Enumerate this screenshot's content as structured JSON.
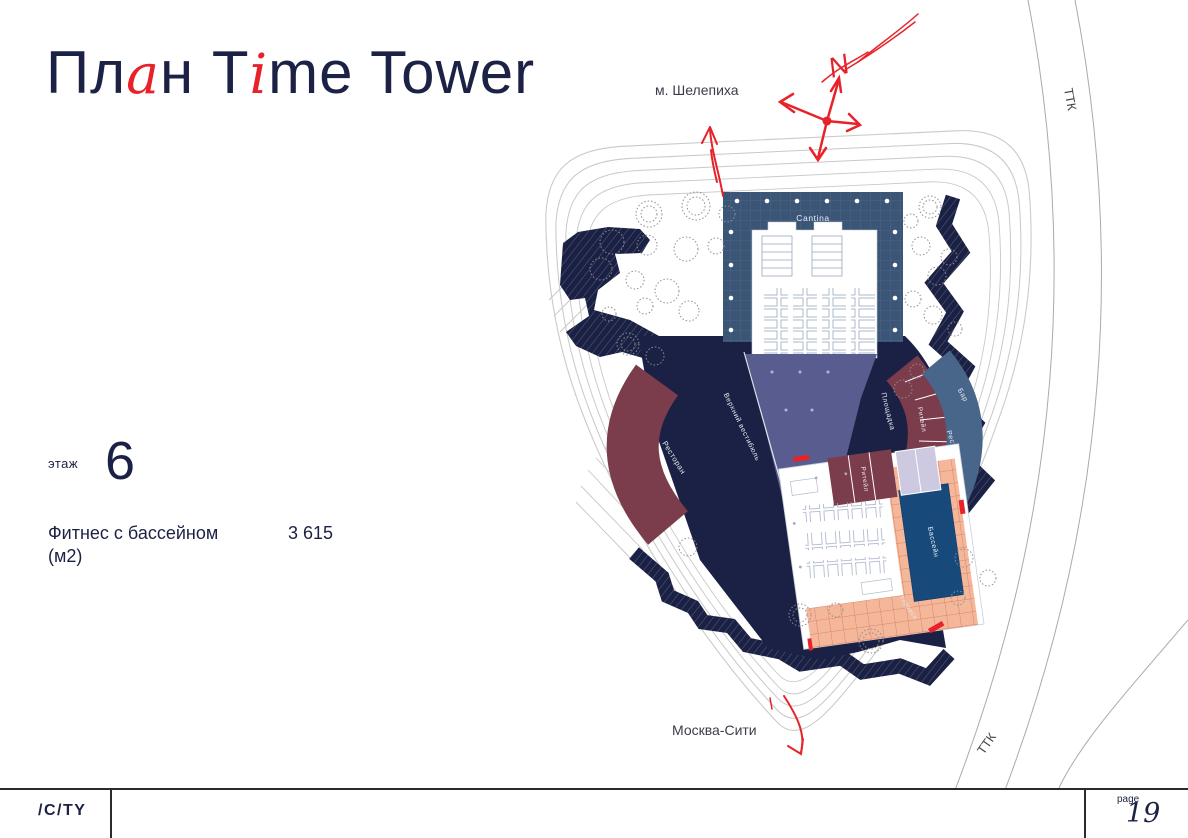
{
  "header": {
    "title_segments": [
      {
        "text": "Пл"
      },
      {
        "text": "а"
      },
      {
        "text": "н"
      },
      {
        "text": " T"
      },
      {
        "text": "i"
      },
      {
        "text": "me Tower"
      }
    ]
  },
  "info": {
    "floor_label": "этаж",
    "floor_number": "6",
    "area_label_line1": "Фитнес с бассейном",
    "area_label_line2": "(м2)",
    "area_value": "3 615"
  },
  "map": {
    "metro_label": "м. Шелепиха",
    "city_label": "Москва-Сити",
    "road_label_top": "ТТК",
    "road_label_bottom": "ТТК",
    "north_label": "N",
    "zones": {
      "cantina": "Cantina",
      "upper_lobby": "Верхний вестибюль",
      "restaurant_left": "Ресторан",
      "plaza": "Площадка",
      "retail_arc": "Ритейл",
      "bar": "Бар",
      "restaurant_right": "Ресторан",
      "retail_box": "Ритейл",
      "pool": "Бассейн",
      "terrace": "Терраса"
    }
  },
  "footer": {
    "logo": "/C/TY",
    "page_label": "page",
    "page_number": "19"
  },
  "colors": {
    "navy": "#1b2144",
    "red": "#e8222a",
    "cantina_blue": "#3b5577",
    "lobby_purple": "#585c8e",
    "burgundy": "#7b3c4c",
    "slate_blue": "#48658a",
    "pool_blue": "#17497b",
    "tile_peach": "#f5b79a",
    "lavender": "#cdc9e0"
  }
}
